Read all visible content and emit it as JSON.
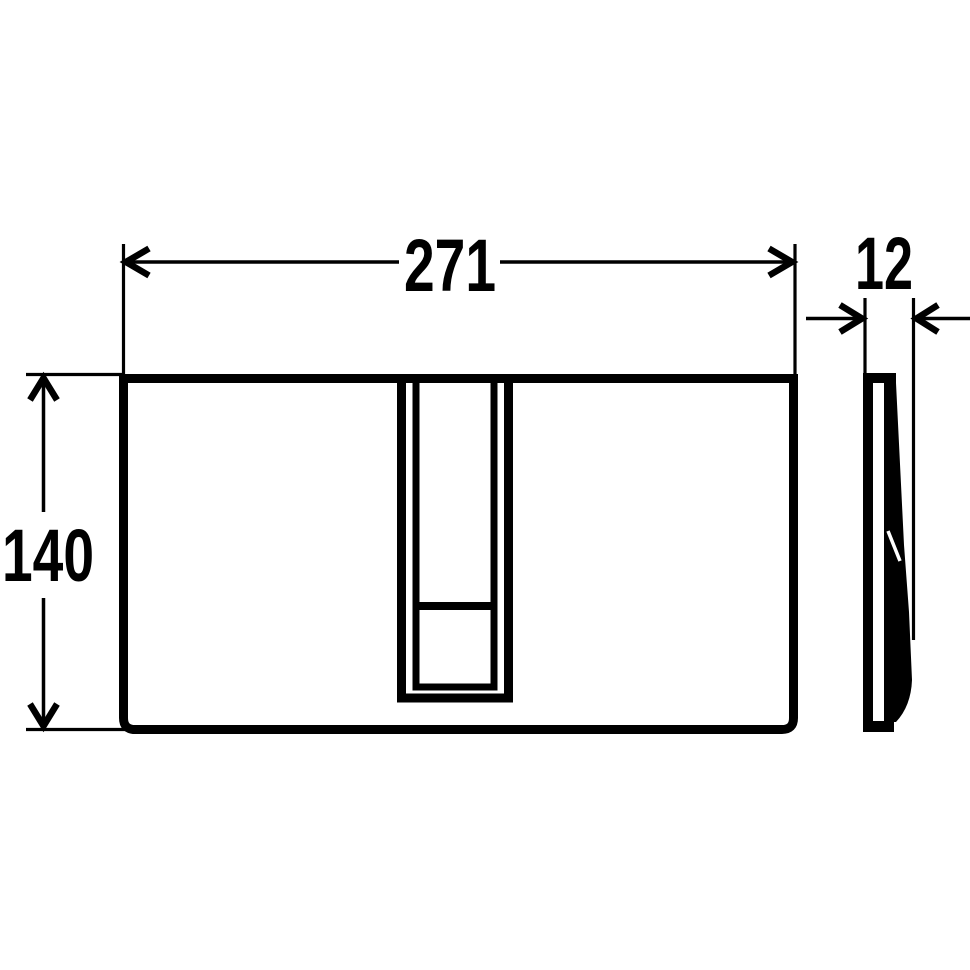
{
  "dimensions": {
    "width": {
      "label": "271"
    },
    "height": {
      "label": "140"
    },
    "depth": {
      "label": "12"
    }
  },
  "colors": {
    "line": "#000000",
    "background": "#ffffff"
  }
}
